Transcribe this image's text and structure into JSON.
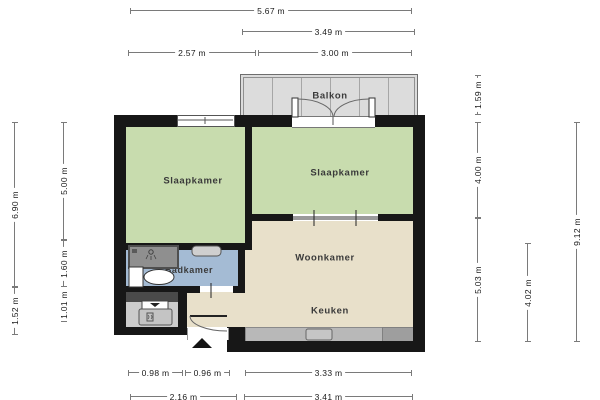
{
  "plan": {
    "type": "floorplan",
    "units": "m"
  },
  "rooms": {
    "balcony": {
      "label": "Balkon"
    },
    "bedroom_left": {
      "label": "Slaapkamer"
    },
    "bedroom_right": {
      "label": "Slaapkamer"
    },
    "bathroom": {
      "label": "Badkamer"
    },
    "living_room": {
      "label": "Woonkamer"
    },
    "kitchen": {
      "label": "Keuken"
    }
  },
  "dimensions": {
    "top": [
      {
        "label": "5.67 m"
      },
      {
        "label": "3.49 m"
      },
      {
        "label": "2.57 m"
      },
      {
        "label": "3.00 m"
      }
    ],
    "bottom": [
      {
        "label": "0.98 m"
      },
      {
        "label": "0.96 m"
      },
      {
        "label": "3.33 m"
      },
      {
        "label": "2.16 m"
      },
      {
        "label": "3.41 m"
      }
    ],
    "left": [
      {
        "label": "6.90 m"
      },
      {
        "label": "1.52 m"
      },
      {
        "label": "5.00 m"
      },
      {
        "label": "1.60 m"
      },
      {
        "label": "1.01 m"
      }
    ],
    "right": [
      {
        "label": "1.59 m"
      },
      {
        "label": "4.00 m"
      },
      {
        "label": "5.03 m"
      },
      {
        "label": "4.02 m"
      },
      {
        "label": "9.12 m"
      }
    ]
  },
  "colors": {
    "bedroom_floor": "#c8dcae",
    "living_floor": "#e8e0ca",
    "bathroom_floor": "#a4bbd4",
    "balcony_floor": "#dcdcdc",
    "storage_floor": "#cccccc",
    "wall": "#171717",
    "counter": "#b8b8b8"
  }
}
